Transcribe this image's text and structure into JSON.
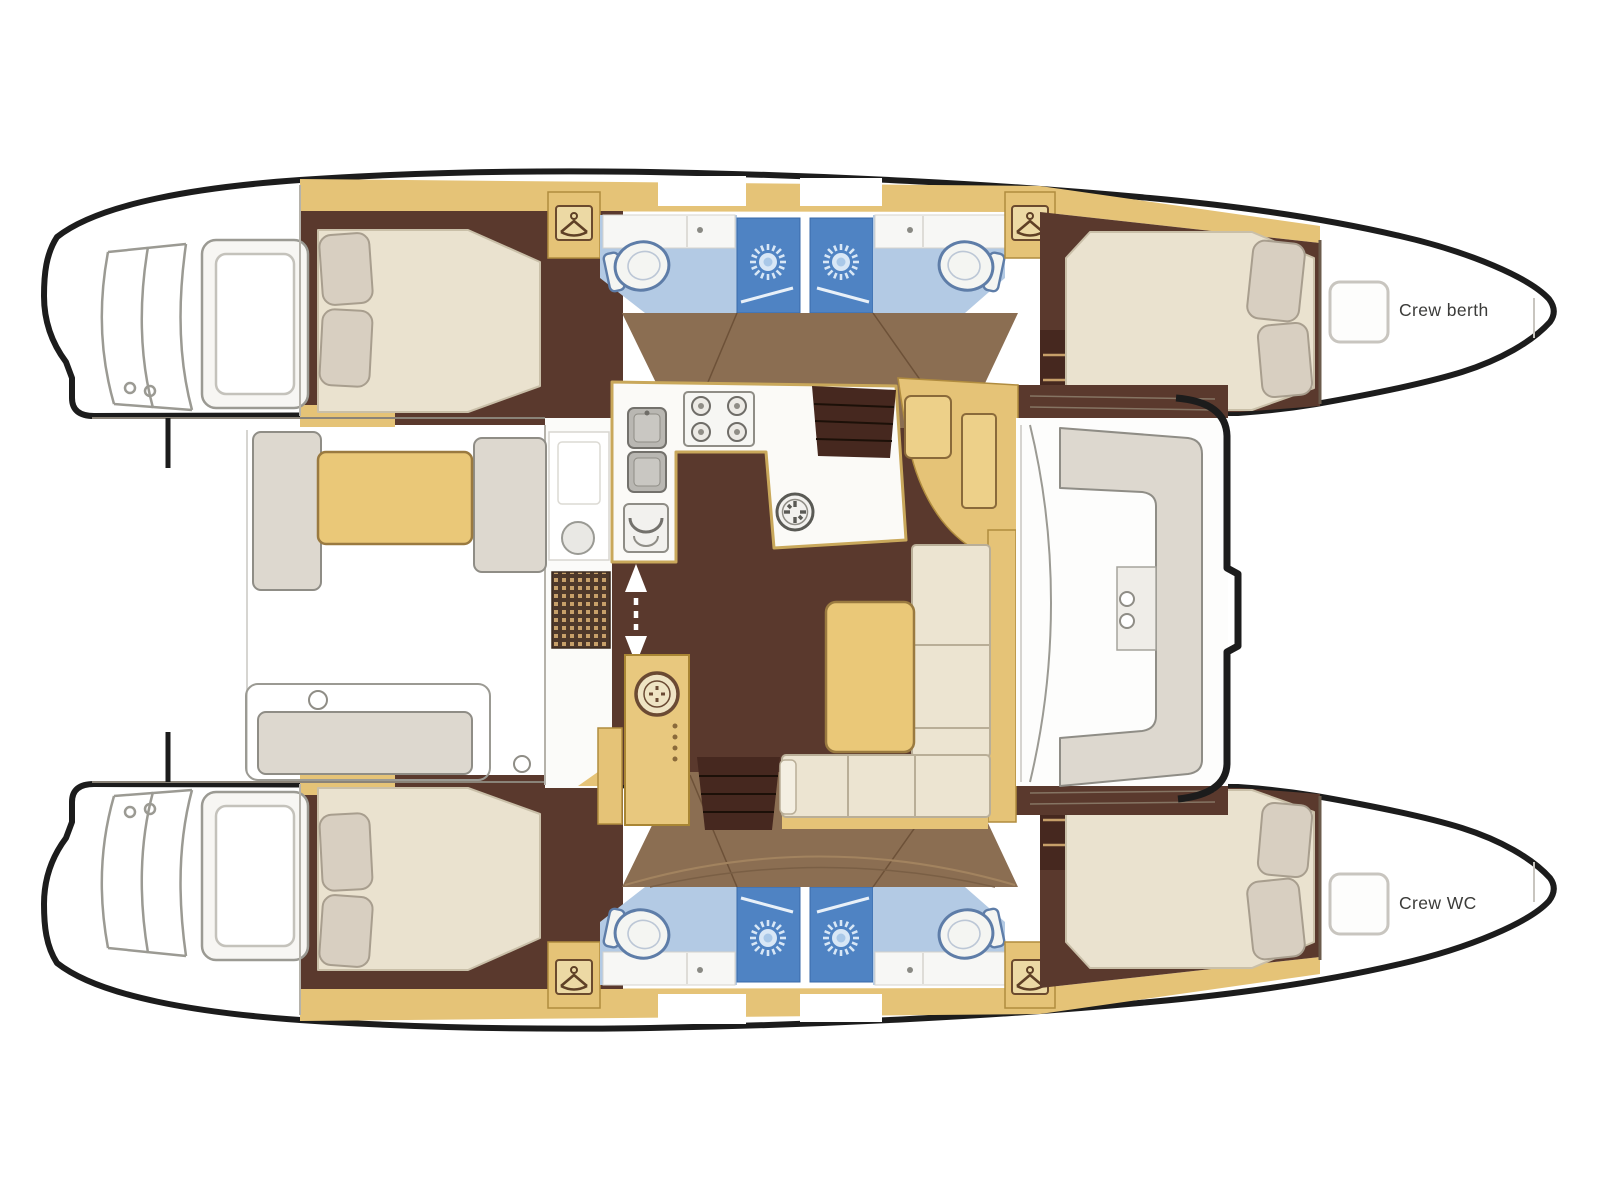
{
  "diagram": {
    "type": "catamaran-yacht-floor-plan",
    "view": "top-down deck layout, bows to the right, swim platforms to the left"
  },
  "labels": {
    "crew_berth": "Crew berth",
    "crew_wc": "Crew WC"
  },
  "palette": {
    "background": "#ffffff",
    "hull_outline": "#1c1c1c",
    "line_art_gray": "#9b9a93",
    "cabin_floor_dark_brown": "#5a392d",
    "walkway_medium_brown": "#8b6e52",
    "cabinetry_tan": "#e5c377",
    "table_yellow": "#eac878",
    "mattress_cream": "#eae2cf",
    "pillow_beige": "#d8cfc1",
    "sofa_cream": "#ece4d1",
    "bench_gray": "#ddd8cf",
    "bathroom_floor_blue": "#b3cae4",
    "shower_stall_blue": "#4f83c3",
    "toilet_outline_blue": "#5e7da8",
    "step_dark_brown": "#46281f"
  },
  "icons": [
    "hanger-locker-icon",
    "shower-head-sun-icon",
    "toilet-icon",
    "sink-icon",
    "stove-burner-icon",
    "oven-icon",
    "round-sink-icon",
    "deck-hatch-wheel-icon",
    "door-wheel-icon",
    "companionway-arrow-icon",
    "cleat-icon"
  ]
}
